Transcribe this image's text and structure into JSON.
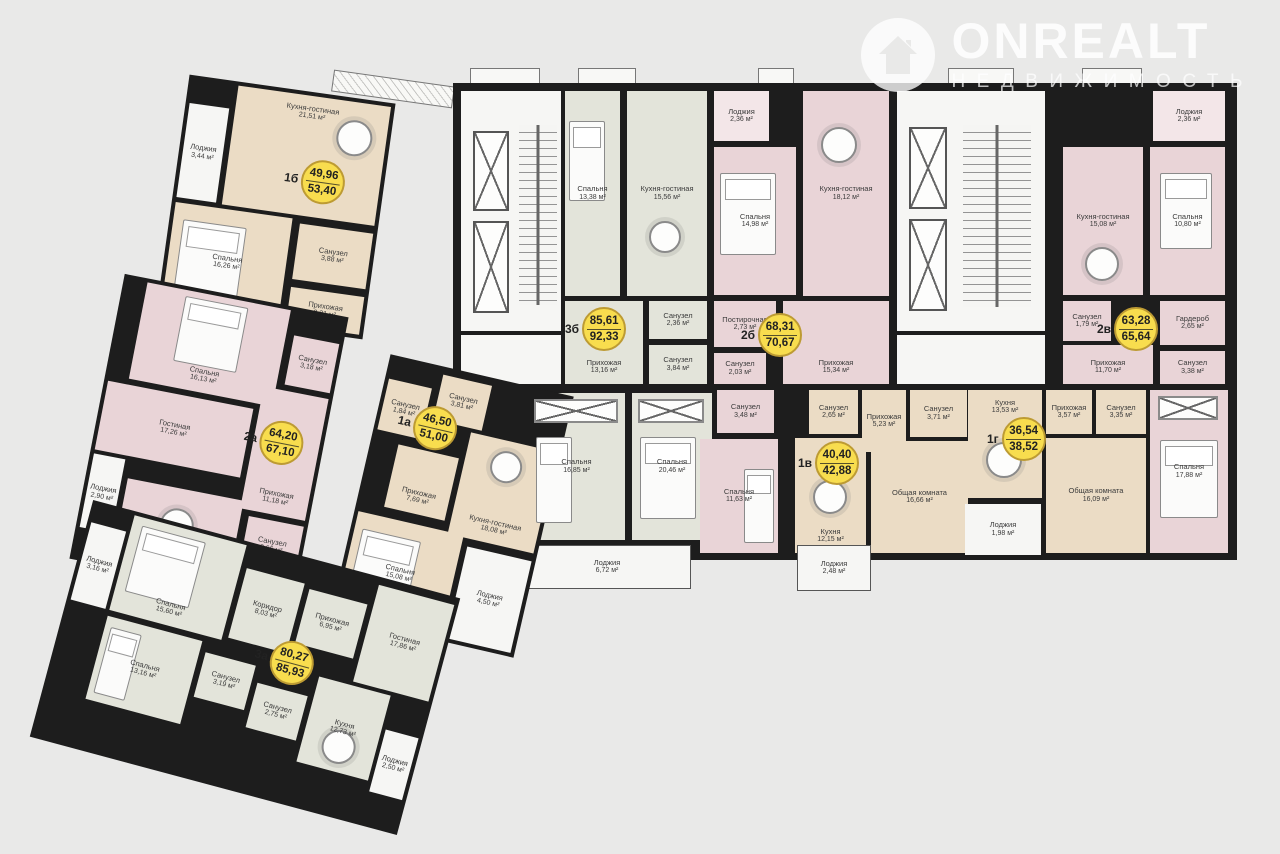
{
  "watermark": {
    "brand": "ONREALT",
    "subtitle": "НЕДВИЖИМОСТЬ",
    "logo": "house-in-circle-icon"
  },
  "palette": {
    "background": "#e9e9e8",
    "walls": "#1d1d1d",
    "badge_fill": "#f8dd4e",
    "badge_border": "#bd9b33",
    "apartment_beige": "#ebdcc5",
    "apartment_pink": "#e9d4d7",
    "apartment_green": "#e3e4da",
    "loggia_white": "#f6f6f4"
  },
  "apartments": [
    {
      "id": "1b",
      "label": "1б",
      "area_living": "49,96",
      "area_total": "53,40",
      "rooms": [
        {
          "name": "Лоджия",
          "area": "3,44 м²"
        },
        {
          "name": "Кухня-гостиная",
          "area": "21,51 м²"
        },
        {
          "name": "Спальня",
          "area": "16,26 м²"
        },
        {
          "name": "Санузел",
          "area": "3,88 м²"
        },
        {
          "name": "Прихожая",
          "area": "8,31 м²"
        }
      ]
    },
    {
      "id": "2a",
      "label": "2а",
      "area_living": "64,20",
      "area_total": "67,10",
      "rooms": [
        {
          "name": "Спальня",
          "area": "16,13 м²"
        },
        {
          "name": "Санузел",
          "area": "3,18 м²"
        },
        {
          "name": "Гостиная",
          "area": "17,26 м²"
        },
        {
          "name": "Лоджия",
          "area": "2,90 м²"
        },
        {
          "name": "Прихожая",
          "area": "11,18 м²"
        },
        {
          "name": "Кухня",
          "area": "12,79 м²"
        },
        {
          "name": "Санузел",
          "area": "3,66 м²"
        }
      ]
    },
    {
      "id": "1a",
      "label": "1а",
      "area_living": "46,50",
      "area_total": "51,00",
      "rooms": [
        {
          "name": "Санузел",
          "area": "1,84 м²"
        },
        {
          "name": "Санузел",
          "area": "3,81 м²"
        },
        {
          "name": "Кухня-гостиная",
          "area": "18,08 м²"
        },
        {
          "name": "Прихожая",
          "area": "7,69 м²"
        },
        {
          "name": "Спальня",
          "area": "15,08 м²"
        },
        {
          "name": "Лоджия",
          "area": "4,50 м²"
        }
      ]
    },
    {
      "id": "3a",
      "label": "3а",
      "area_living": "80,27",
      "area_total": "85,93",
      "rooms": [
        {
          "name": "Лоджия",
          "area": "3,16 м²"
        },
        {
          "name": "Спальня",
          "area": "15,60 м²"
        },
        {
          "name": "Спальня",
          "area": "13,16 м²"
        },
        {
          "name": "Коридор",
          "area": "8,03 м²"
        },
        {
          "name": "Прихожая",
          "area": "6,95 м²"
        },
        {
          "name": "Санузел",
          "area": "3,19 м²"
        },
        {
          "name": "Санузел",
          "area": "2,75 м²"
        },
        {
          "name": "Гостиная",
          "area": "17,86 м²"
        },
        {
          "name": "Кухня",
          "area": "12,73 м²"
        },
        {
          "name": "Лоджия",
          "area": "2,50 м²"
        }
      ]
    },
    {
      "id": "3b",
      "label": "3б",
      "area_living": "85,61",
      "area_total": "92,33",
      "rooms": [
        {
          "name": "Спальня",
          "area": "13,38 м²"
        },
        {
          "name": "Кухня-гостиная",
          "area": "15,56 м²"
        },
        {
          "name": "Санузел",
          "area": "2,36 м²"
        },
        {
          "name": "Санузел",
          "area": "3,84 м²"
        },
        {
          "name": "Прихожая",
          "area": "13,16 м²"
        },
        {
          "name": "Спальня",
          "area": "16,85 м²"
        },
        {
          "name": "Спальня",
          "area": "20,46 м²"
        },
        {
          "name": "Лоджия",
          "area": "6,72 м²"
        }
      ]
    },
    {
      "id": "2b",
      "label": "2б",
      "area_living": "68,31",
      "area_total": "70,67",
      "rooms": [
        {
          "name": "Лоджия",
          "area": "2,36 м²"
        },
        {
          "name": "Спальня",
          "area": "14,98 м²"
        },
        {
          "name": "Кухня-гостиная",
          "area": "18,12 м²"
        },
        {
          "name": "Постирочная",
          "area": "2,73 м²"
        },
        {
          "name": "Санузел",
          "area": "2,03 м²"
        },
        {
          "name": "Прихожая",
          "area": "15,34 м²"
        },
        {
          "name": "Санузел",
          "area": "3,48 м²"
        },
        {
          "name": "Спальня",
          "area": "11,63 м²"
        }
      ]
    },
    {
      "id": "1v",
      "label": "1в",
      "area_living": "40,40",
      "area_total": "42,88",
      "rooms": [
        {
          "name": "Санузел",
          "area": "2,65 м²"
        },
        {
          "name": "Прихожая",
          "area": "5,23 м²"
        },
        {
          "name": "Санузел",
          "area": "3,71 м²"
        },
        {
          "name": "Кухня",
          "area": "12,15 м²"
        },
        {
          "name": "Общая комната",
          "area": "16,66 м²"
        },
        {
          "name": "Лоджия",
          "area": "2,48 м²"
        }
      ]
    },
    {
      "id": "1g",
      "label": "1г",
      "area_living": "36,54",
      "area_total": "38,52",
      "rooms": [
        {
          "name": "Кухня",
          "area": "13,53 м²"
        },
        {
          "name": "Прихожая",
          "area": "3,57 м²"
        },
        {
          "name": "Санузел",
          "area": "3,35 м²"
        },
        {
          "name": "Общая комната",
          "area": "16,09 м²"
        },
        {
          "name": "Лоджия",
          "area": "1,98 м²"
        }
      ]
    },
    {
      "id": "2v",
      "label": "2в",
      "area_living": "63,28",
      "area_total": "65,64",
      "rooms": [
        {
          "name": "Лоджия",
          "area": "2,36 м²"
        },
        {
          "name": "Кухня-гостиная",
          "area": "15,08 м²"
        },
        {
          "name": "Спальня",
          "area": "10,80 м²"
        },
        {
          "name": "Санузел",
          "area": "1,79 м²"
        },
        {
          "name": "Гардероб",
          "area": "2,65 м²"
        },
        {
          "name": "Прихожая",
          "area": "11,70 м²"
        },
        {
          "name": "Санузел",
          "area": "3,38 м²"
        },
        {
          "name": "Спальня",
          "area": "17,88 м²"
        }
      ]
    }
  ]
}
